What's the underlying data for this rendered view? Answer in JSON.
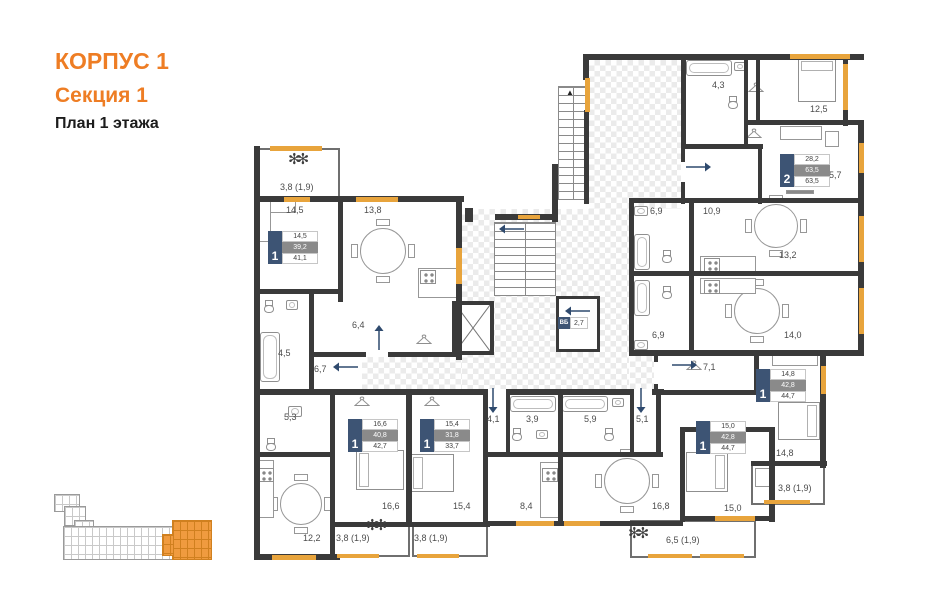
{
  "header": {
    "building": "КОРПУС 1",
    "section": "Секция 1",
    "floor": "План 1 этажа"
  },
  "apartments": [
    {
      "type": "1",
      "living": "14,5",
      "area": "39,2",
      "total": "41,1"
    },
    {
      "type": "1",
      "living": "16,6",
      "area": "40,8",
      "total": "42,7"
    },
    {
      "type": "1",
      "living": "15,4",
      "area": "31,8",
      "total": "33,7"
    },
    {
      "type": "1",
      "living": "15,0",
      "area": "42,8",
      "total": "44,7"
    },
    {
      "type": "1",
      "living": "14,8",
      "area": "42,8",
      "total": "44,7"
    },
    {
      "type": "2",
      "living": "28,2",
      "area": "63,5",
      "total": "63,5"
    }
  ],
  "rooms": {
    "balcony_a": "3,8 (1,9)",
    "room_a": "14,5",
    "kitchen_a": "13,8",
    "hall_a": "6,4",
    "bath_a": "4,5",
    "hall_b": "6,7",
    "bath_b": "5,3",
    "kitchen_b": "12,2",
    "bedroom_b": "16,6",
    "balcony_b": "3,8 (1,9)",
    "bedroom_c": "15,4",
    "balcony_c": "3,8 (1,9)",
    "hall_c": "4,1",
    "bath_c": "3,9",
    "kitchen_c": "8,4",
    "bath_d": "5,9",
    "hall_d": "5,1",
    "kitchen_d": "16,8",
    "balcony_d": "6,5 (1,9)",
    "bedroom_d": "15,0",
    "hall_e": "7,1",
    "bedroom_e": "14,8",
    "balcony_e": "3,8 (1,9)",
    "bath_e": "6,9",
    "kitchen_e": "14,0",
    "bath_f1": "4,3",
    "bedroom_f": "12,5",
    "living_f": "15,7",
    "hall_f": "10,9",
    "bath_f2": "6,9",
    "kitchen_f": "13,2"
  },
  "core": {
    "vb": "ВБ",
    "vb_area": "2,7"
  }
}
